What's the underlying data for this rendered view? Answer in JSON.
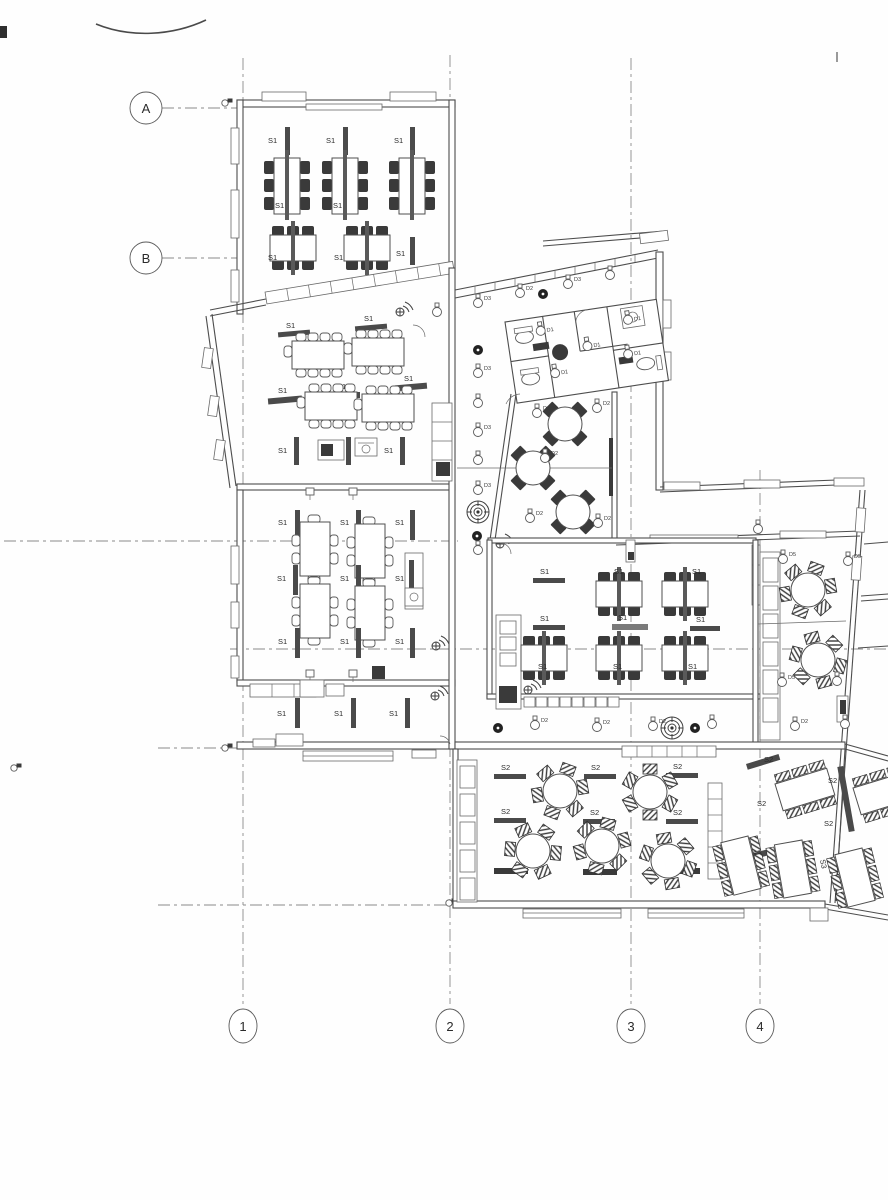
{
  "grid": {
    "rows": [
      "A",
      "B"
    ],
    "cols": [
      "1",
      "2",
      "3",
      "4"
    ]
  },
  "labels": {
    "s1": "S1",
    "s2": "S2",
    "s3": "S3"
  },
  "devices": {
    "d1": "D1",
    "d2": "D2",
    "d3": "D3",
    "d5": "D5"
  },
  "colors": {
    "line": "#4d4d4d",
    "furniture_dark": "#3a3a3a",
    "grid_dash": "#8b8b8b",
    "paper": "#fefefe"
  }
}
